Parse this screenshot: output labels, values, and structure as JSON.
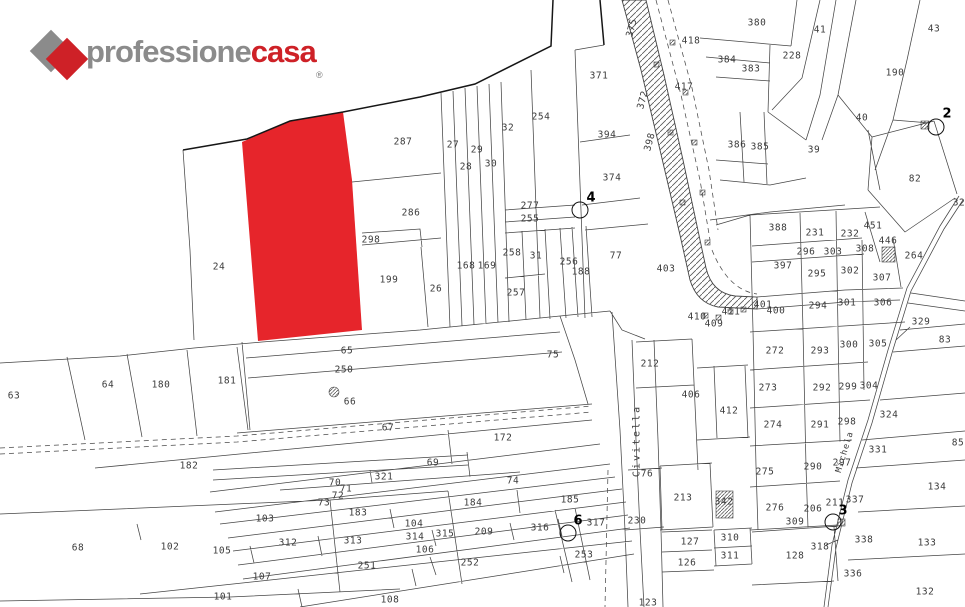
{
  "logo": {
    "brand_gray": "professione",
    "brand_red": "casa",
    "registered": "®"
  },
  "colors": {
    "logo_red": "#ce2127",
    "logo_gray": "#8b8b8b",
    "highlight_parcel_red": "#e6252b"
  },
  "map": {
    "region_label": "Civitella",
    "road_label": "Michela",
    "parcels": [
      {
        "n": "24",
        "x": 219,
        "y": 267
      },
      {
        "n": "287",
        "x": 403,
        "y": 142
      },
      {
        "n": "286",
        "x": 411,
        "y": 213
      },
      {
        "n": "298",
        "x": 371,
        "y": 240
      },
      {
        "n": "199",
        "x": 389,
        "y": 280
      },
      {
        "n": "26",
        "x": 436,
        "y": 289
      },
      {
        "n": "27",
        "x": 453,
        "y": 145
      },
      {
        "n": "28",
        "x": 466,
        "y": 167
      },
      {
        "n": "29",
        "x": 477,
        "y": 150
      },
      {
        "n": "30",
        "x": 491,
        "y": 164
      },
      {
        "n": "32",
        "x": 508,
        "y": 128
      },
      {
        "n": "254",
        "x": 541,
        "y": 117
      },
      {
        "n": "277",
        "x": 530,
        "y": 206
      },
      {
        "n": "255",
        "x": 530,
        "y": 219
      },
      {
        "n": "258",
        "x": 512,
        "y": 253
      },
      {
        "n": "31",
        "x": 536,
        "y": 256
      },
      {
        "n": "257",
        "x": 516,
        "y": 293
      },
      {
        "n": "168",
        "x": 466,
        "y": 266
      },
      {
        "n": "169",
        "x": 487,
        "y": 266
      },
      {
        "n": "256",
        "x": 569,
        "y": 262
      },
      {
        "n": "188",
        "x": 581,
        "y": 272
      },
      {
        "n": "77",
        "x": 616,
        "y": 256
      },
      {
        "n": "371",
        "x": 599,
        "y": 76
      },
      {
        "n": "394",
        "x": 607,
        "y": 135
      },
      {
        "n": "374",
        "x": 612,
        "y": 178
      },
      {
        "n": "403",
        "x": 666,
        "y": 269
      },
      {
        "n": "380",
        "x": 757,
        "y": 23
      },
      {
        "n": "41",
        "x": 820,
        "y": 30
      },
      {
        "n": "43",
        "x": 934,
        "y": 29
      },
      {
        "n": "418",
        "x": 691,
        "y": 41
      },
      {
        "n": "384",
        "x": 727,
        "y": 60
      },
      {
        "n": "383",
        "x": 751,
        "y": 69
      },
      {
        "n": "228",
        "x": 792,
        "y": 56
      },
      {
        "n": "190",
        "x": 895,
        "y": 73
      },
      {
        "n": "417",
        "x": 684,
        "y": 87
      },
      {
        "n": "40",
        "x": 862,
        "y": 118
      },
      {
        "n": "39",
        "x": 814,
        "y": 150
      },
      {
        "n": "386",
        "x": 737,
        "y": 145
      },
      {
        "n": "385",
        "x": 760,
        "y": 147
      },
      {
        "n": "82",
        "x": 915,
        "y": 179
      },
      {
        "n": "388",
        "x": 778,
        "y": 228
      },
      {
        "n": "231",
        "x": 815,
        "y": 233
      },
      {
        "n": "232",
        "x": 850,
        "y": 234
      },
      {
        "n": "451",
        "x": 873,
        "y": 226
      },
      {
        "n": "446",
        "x": 888,
        "y": 241
      },
      {
        "n": "308",
        "x": 865,
        "y": 249
      },
      {
        "n": "296",
        "x": 806,
        "y": 252
      },
      {
        "n": "303",
        "x": 833,
        "y": 252
      },
      {
        "n": "264",
        "x": 914,
        "y": 256
      },
      {
        "n": "397",
        "x": 783,
        "y": 266
      },
      {
        "n": "295",
        "x": 817,
        "y": 274
      },
      {
        "n": "302",
        "x": 850,
        "y": 271
      },
      {
        "n": "307",
        "x": 882,
        "y": 278
      },
      {
        "n": "294",
        "x": 818,
        "y": 306
      },
      {
        "n": "301",
        "x": 847,
        "y": 303
      },
      {
        "n": "306",
        "x": 883,
        "y": 303
      },
      {
        "n": "329",
        "x": 921,
        "y": 322
      },
      {
        "n": "83",
        "x": 945,
        "y": 340
      },
      {
        "n": "300",
        "x": 849,
        "y": 345
      },
      {
        "n": "305",
        "x": 878,
        "y": 344
      },
      {
        "n": "272",
        "x": 775,
        "y": 351
      },
      {
        "n": "293",
        "x": 820,
        "y": 351
      },
      {
        "n": "273",
        "x": 768,
        "y": 388
      },
      {
        "n": "292",
        "x": 822,
        "y": 388
      },
      {
        "n": "299",
        "x": 848,
        "y": 387
      },
      {
        "n": "304",
        "x": 869,
        "y": 386
      },
      {
        "n": "274",
        "x": 773,
        "y": 425
      },
      {
        "n": "291",
        "x": 820,
        "y": 425
      },
      {
        "n": "298",
        "x": 847,
        "y": 422
      },
      {
        "n": "324",
        "x": 889,
        "y": 415
      },
      {
        "n": "331",
        "x": 878,
        "y": 450
      },
      {
        "n": "297",
        "x": 842,
        "y": 463
      },
      {
        "n": "337",
        "x": 855,
        "y": 500
      },
      {
        "n": "211",
        "x": 835,
        "y": 503
      },
      {
        "n": "32",
        "x": 959,
        "y": 203
      },
      {
        "n": "400",
        "x": 776,
        "y": 311
      },
      {
        "n": "401",
        "x": 763,
        "y": 305
      },
      {
        "n": "409",
        "x": 714,
        "y": 324
      },
      {
        "n": "410",
        "x": 697,
        "y": 317
      },
      {
        "n": "411",
        "x": 731,
        "y": 312
      },
      {
        "n": "406",
        "x": 691,
        "y": 395
      },
      {
        "n": "412",
        "x": 729,
        "y": 411
      },
      {
        "n": "212",
        "x": 650,
        "y": 364
      },
      {
        "n": "76",
        "x": 647,
        "y": 474
      },
      {
        "n": "213",
        "x": 683,
        "y": 498
      },
      {
        "n": "342",
        "x": 724,
        "y": 502
      },
      {
        "n": "230",
        "x": 637,
        "y": 521
      },
      {
        "n": "127",
        "x": 690,
        "y": 542
      },
      {
        "n": "126",
        "x": 687,
        "y": 563
      },
      {
        "n": "310",
        "x": 730,
        "y": 538
      },
      {
        "n": "311",
        "x": 730,
        "y": 556
      },
      {
        "n": "128",
        "x": 795,
        "y": 556
      },
      {
        "n": "318",
        "x": 820,
        "y": 547
      },
      {
        "n": "338",
        "x": 864,
        "y": 540
      },
      {
        "n": "336",
        "x": 853,
        "y": 574
      },
      {
        "n": "133",
        "x": 927,
        "y": 543
      },
      {
        "n": "134",
        "x": 937,
        "y": 487
      },
      {
        "n": "132",
        "x": 925,
        "y": 592
      },
      {
        "n": "85",
        "x": 958,
        "y": 443
      },
      {
        "n": "123",
        "x": 648,
        "y": 603
      },
      {
        "n": "253",
        "x": 584,
        "y": 555
      },
      {
        "n": "252",
        "x": 470,
        "y": 563
      },
      {
        "n": "251",
        "x": 367,
        "y": 566
      },
      {
        "n": "275",
        "x": 765,
        "y": 472
      },
      {
        "n": "276",
        "x": 775,
        "y": 508
      },
      {
        "n": "290",
        "x": 813,
        "y": 467
      },
      {
        "n": "206",
        "x": 813,
        "y": 509
      },
      {
        "n": "309",
        "x": 795,
        "y": 522
      },
      {
        "n": "63",
        "x": 14,
        "y": 396
      },
      {
        "n": "64",
        "x": 108,
        "y": 385
      },
      {
        "n": "180",
        "x": 161,
        "y": 385
      },
      {
        "n": "181",
        "x": 227,
        "y": 381
      },
      {
        "n": "182",
        "x": 189,
        "y": 466
      },
      {
        "n": "75",
        "x": 553,
        "y": 355
      },
      {
        "n": "65",
        "x": 347,
        "y": 351
      },
      {
        "n": "250",
        "x": 344,
        "y": 370
      },
      {
        "n": "66",
        "x": 350,
        "y": 402
      },
      {
        "n": "67",
        "x": 388,
        "y": 428
      },
      {
        "n": "172",
        "x": 503,
        "y": 438
      },
      {
        "n": "69",
        "x": 433,
        "y": 463
      },
      {
        "n": "70",
        "x": 335,
        "y": 483
      },
      {
        "n": "71",
        "x": 346,
        "y": 489
      },
      {
        "n": "72",
        "x": 338,
        "y": 496
      },
      {
        "n": "73",
        "x": 324,
        "y": 503
      },
      {
        "n": "321",
        "x": 384,
        "y": 477
      },
      {
        "n": "74",
        "x": 513,
        "y": 481
      },
      {
        "n": "184",
        "x": 473,
        "y": 503
      },
      {
        "n": "185",
        "x": 570,
        "y": 500
      },
      {
        "n": "103",
        "x": 265,
        "y": 519
      },
      {
        "n": "183",
        "x": 358,
        "y": 513
      },
      {
        "n": "104",
        "x": 414,
        "y": 524
      },
      {
        "n": "312",
        "x": 288,
        "y": 543
      },
      {
        "n": "313",
        "x": 353,
        "y": 541
      },
      {
        "n": "314",
        "x": 415,
        "y": 537
      },
      {
        "n": "315",
        "x": 445,
        "y": 534
      },
      {
        "n": "209",
        "x": 484,
        "y": 532
      },
      {
        "n": "316",
        "x": 540,
        "y": 528
      },
      {
        "n": "317",
        "x": 596,
        "y": 523
      },
      {
        "n": "105",
        "x": 222,
        "y": 551
      },
      {
        "n": "106",
        "x": 425,
        "y": 550
      },
      {
        "n": "107",
        "x": 262,
        "y": 577
      },
      {
        "n": "101",
        "x": 223,
        "y": 597
      },
      {
        "n": "108",
        "x": 390,
        "y": 600
      },
      {
        "n": "102",
        "x": 170,
        "y": 547
      },
      {
        "n": "68",
        "x": 78,
        "y": 548
      }
    ],
    "rotated_labels": [
      {
        "n": "375",
        "x": 632,
        "y": 28
      },
      {
        "n": "372",
        "x": 643,
        "y": 100
      },
      {
        "n": "398",
        "x": 650,
        "y": 142
      }
    ],
    "survey_points": [
      {
        "n": "4",
        "nx": 591,
        "ny": 198,
        "cx": 580,
        "cy": 210
      },
      {
        "n": "2",
        "nx": 947,
        "ny": 114,
        "cx": 936,
        "cy": 127
      },
      {
        "n": "6",
        "nx": 578,
        "ny": 521,
        "cx": 568,
        "cy": 533
      },
      {
        "n": "3",
        "nx": 843,
        "ny": 511,
        "cx": 833,
        "cy": 522
      }
    ]
  }
}
